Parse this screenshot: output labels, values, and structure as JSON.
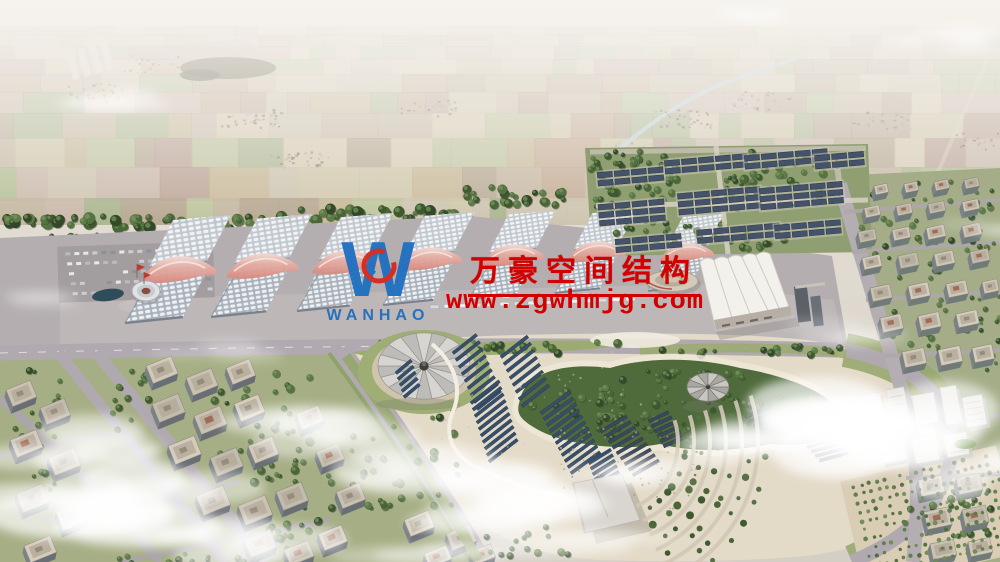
{
  "meta": {
    "type": "aerial-architectural-rendering",
    "subject": "exhibition center and surrounding district",
    "canvas": {
      "width": 1000,
      "height": 562
    }
  },
  "watermark": {
    "company_name_cn": "万豪空间结构",
    "website": "www.zgwhmjg.com",
    "logo_text": "WANHAO"
  },
  "colors": {
    "watermark_red": "#d40000",
    "logo_blue": "#1e6fc0",
    "canopy_pink": "#dd9a8f",
    "roof_grid_white": "#eef1f4",
    "solar_navy": "#3a516b",
    "plaza_beige": "#e3dac7",
    "tree_green": "#4a6538",
    "road_gray": "#aba5a9",
    "pond_teal": "#2f4c59",
    "haze_white": "#f4f1ec"
  }
}
